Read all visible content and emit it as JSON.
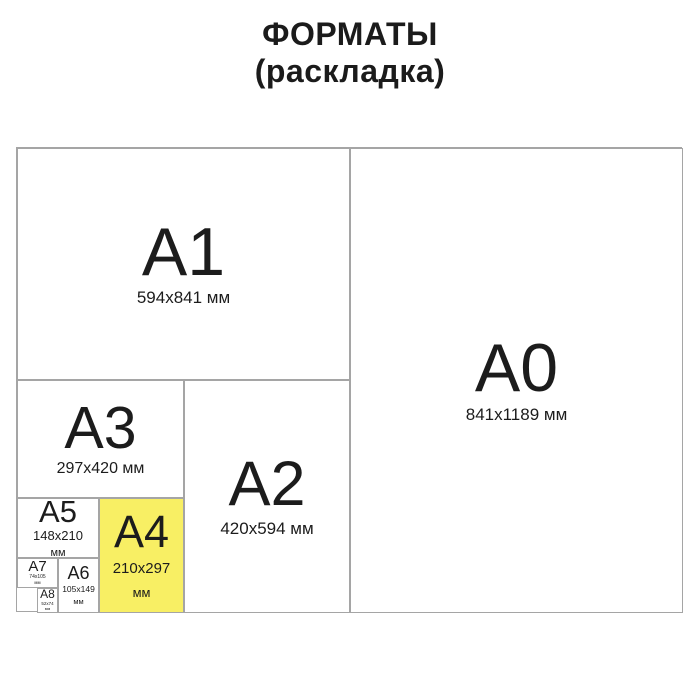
{
  "title": {
    "line1": "ФОРМАТЫ",
    "line2": "(раскладка)"
  },
  "diagram": {
    "highlight_color": "#f8ef64",
    "border_color": "#a5a5a5",
    "text_color": "#1c1c1c",
    "formats": [
      {
        "label": "A0",
        "size_line1": "841x1189 мм",
        "highlighted": false
      },
      {
        "label": "A1",
        "size_line1": "594x841 мм",
        "highlighted": false
      },
      {
        "label": "A2",
        "size_line1": "420x594 мм",
        "highlighted": false
      },
      {
        "label": "A3",
        "size_line1": "297x420 мм",
        "highlighted": false
      },
      {
        "label": "A4",
        "size_line1": "210x297",
        "size_line2": "мм",
        "highlighted": true
      },
      {
        "label": "A5",
        "size_line1": "148x210",
        "size_line2": "мм",
        "highlighted": false
      },
      {
        "label": "A6",
        "size_line1": "105x149",
        "size_line2": "мм",
        "highlighted": false
      },
      {
        "label": "A7",
        "size_line1": "74x105",
        "size_line2": "мм",
        "highlighted": false
      },
      {
        "label": "A8",
        "size_line1": "52x74",
        "size_line2": "мм",
        "highlighted": false
      }
    ]
  }
}
